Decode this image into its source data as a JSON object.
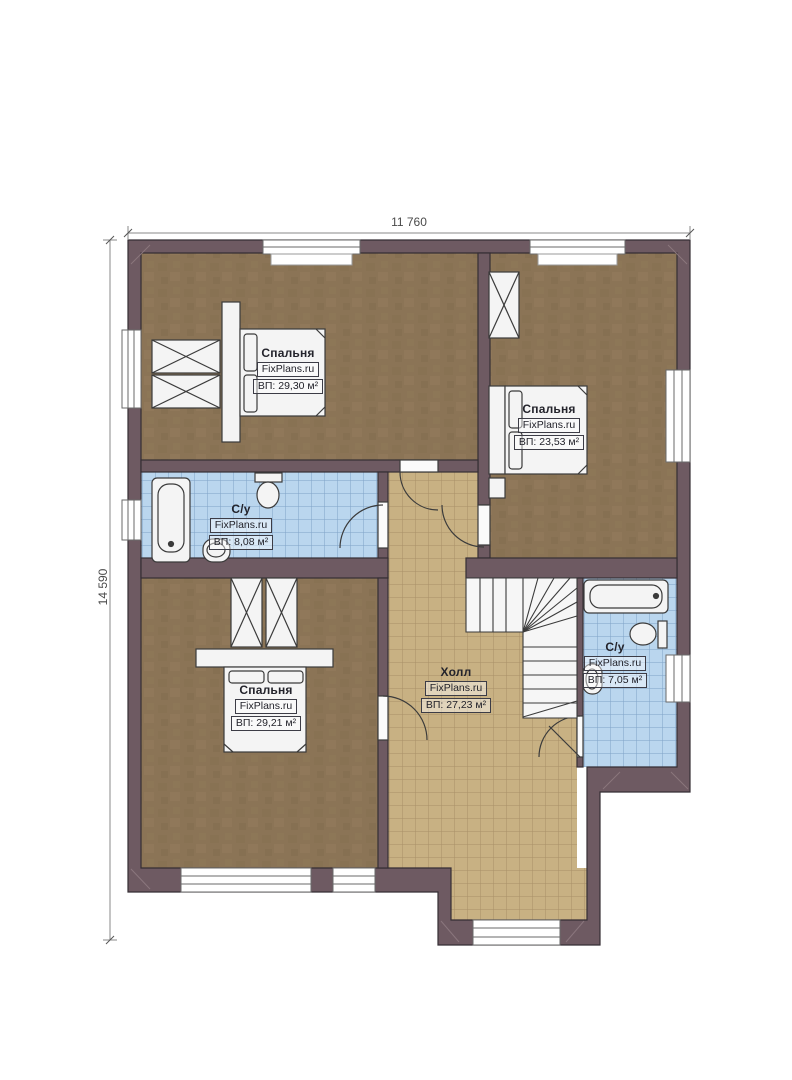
{
  "plan": {
    "type": "floor-plan",
    "watermark": "FixPlans.ru"
  },
  "dimensions": {
    "width_label": "11 760",
    "height_label": "14 590"
  },
  "rooms": [
    {
      "id": "bedroom-top-left",
      "name": "Спальня",
      "brand": "FixPlans.ru",
      "area": "ВП: 29,30 м²"
    },
    {
      "id": "bedroom-top-right",
      "name": "Спальня",
      "brand": "FixPlans.ru",
      "area": "ВП: 23,53 м²"
    },
    {
      "id": "bathroom-left",
      "name": "С/у",
      "brand": "FixPlans.ru",
      "area": "ВП: 8,08 м²"
    },
    {
      "id": "bedroom-bottom-left",
      "name": "Спальня",
      "brand": "FixPlans.ru",
      "area": "ВП: 29,21 м²"
    },
    {
      "id": "hall",
      "name": "Холл",
      "brand": "FixPlans.ru",
      "area": "ВП: 27,23 м²"
    },
    {
      "id": "bathroom-right",
      "name": "С/у",
      "brand": "FixPlans.ru",
      "area": "ВП: 7,05 м²"
    }
  ],
  "colors": {
    "wall": "#6e5a62",
    "wall_outline": "#352e34",
    "bedroom_floor": "#8b7456",
    "hall_floor": "#c8b183",
    "bath_floor": "#bad6ee",
    "fixture": "#f4f4f4",
    "dimension_text": "#4a4a4a"
  }
}
